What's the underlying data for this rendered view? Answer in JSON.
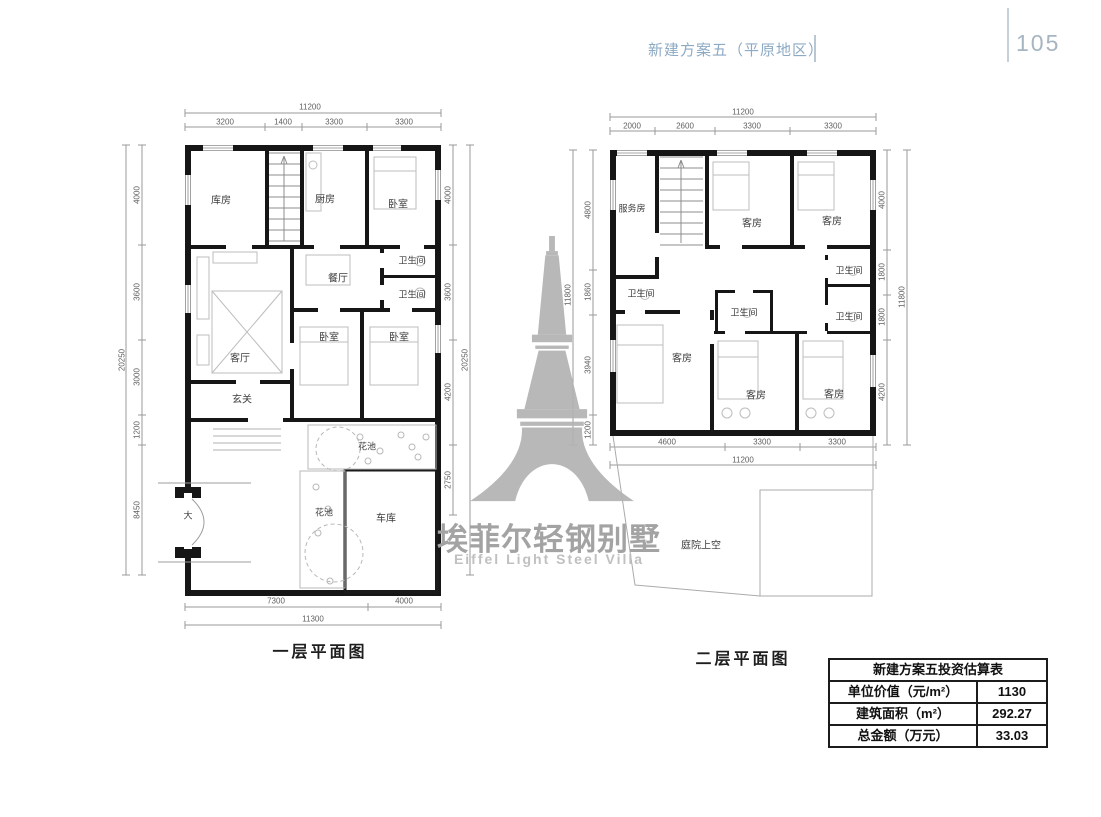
{
  "header": {
    "title": "新建方案五（平原地区）",
    "page_number": "105"
  },
  "watermark": {
    "cn": "埃菲尔轻钢别墅",
    "en": "Eiffel Light Steel Villa"
  },
  "plan1": {
    "caption": "一层平面图",
    "rooms": {
      "storage": "库房",
      "kitchen": "厨房",
      "bedroom_top": "卧室",
      "bath_top": "卫生间",
      "bath_bottom": "卫生间",
      "dining": "餐厅",
      "living": "客厅",
      "bedroom_mid": "卧室",
      "bedroom_right": "卧室",
      "entry": "玄关",
      "flower_top": "花池",
      "flower_strip": "花池",
      "garage": "车库",
      "gate": "大"
    },
    "dims": {
      "top_total": "11200",
      "top": [
        "3200",
        "1400",
        "3300",
        "3300"
      ],
      "left": [
        "4000",
        "3600",
        "3000",
        "1200",
        "8450"
      ],
      "left_total": "20250",
      "right": [
        "4000",
        "3600",
        "4200",
        "2750"
      ],
      "right_total": "20250",
      "bottom": [
        "7300",
        "4000"
      ],
      "bottom_total": "11300"
    }
  },
  "plan2": {
    "caption": "二层平面图",
    "rooms": {
      "service": "服务房",
      "guest_top1": "客房",
      "guest_top2": "客房",
      "bath_left": "卫生间",
      "bath_tr": "卫生间",
      "bath_mid": "卫生间",
      "bath_right": "卫生间",
      "guest_left": "客房",
      "guest_mid": "客房",
      "guest_right": "客房",
      "courtyard": "庭院上空"
    },
    "dims": {
      "top_total": "11200",
      "top": [
        "2000",
        "2600",
        "3300",
        "3300"
      ],
      "left": [
        "4800",
        "1860",
        "3940",
        "1200"
      ],
      "left_total": "11800",
      "right": [
        "4000",
        "1800",
        "1800",
        "4200"
      ],
      "right_total": "11800",
      "bottom": [
        "4600",
        "3300",
        "3300"
      ],
      "bottom_total": "11200"
    }
  },
  "estimate_table": {
    "title": "新建方案五投资估算表",
    "rows": [
      {
        "label": "单位价值（元/m²）",
        "value": "1130"
      },
      {
        "label": "建筑面积（m²）",
        "value": "292.27"
      },
      {
        "label": "总金额（万元）",
        "value": "33.03"
      }
    ]
  }
}
